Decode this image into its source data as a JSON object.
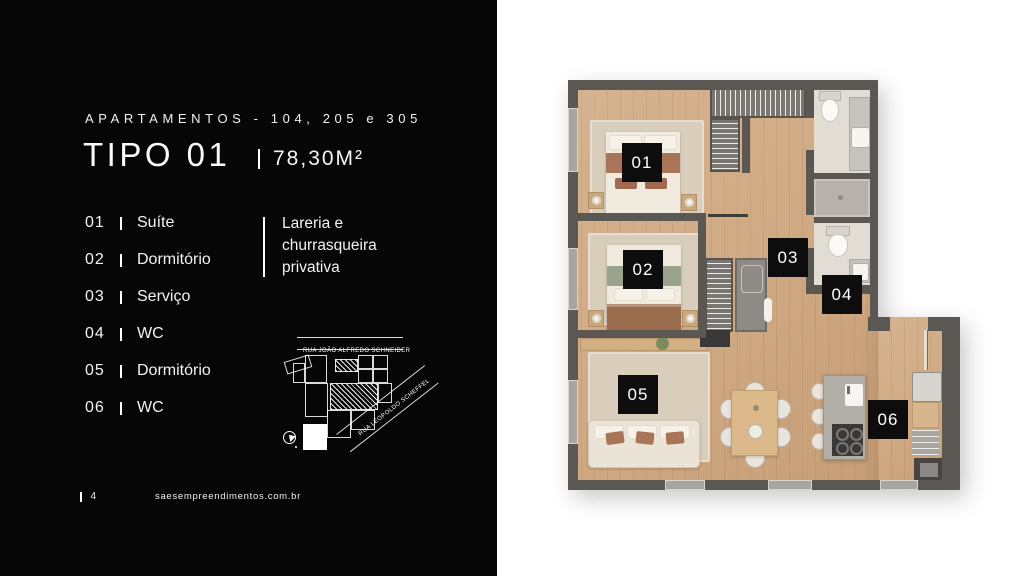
{
  "panel": {
    "subtitle": "APARTAMENTOS - 104, 205 e 305",
    "title": "TIPO 01",
    "area": "78,30M²",
    "rooms": [
      {
        "num": "01",
        "label": "Suíte"
      },
      {
        "num": "02",
        "label": "Dormitório"
      },
      {
        "num": "03",
        "label": "Serviço"
      },
      {
        "num": "04",
        "label": "WC"
      },
      {
        "num": "05",
        "label": "Dormitório"
      },
      {
        "num": "06",
        "label": "WC"
      }
    ],
    "feature": "Lareria e churrasqueira privativa",
    "map": {
      "street_top": "RUA JOÃO ALFREDO SCHNEIDER",
      "street_diagonal": "RUA LEOPOLDO SCHEFFEL"
    },
    "footer": {
      "page": "4",
      "site": "saesempreendimentos.com.br"
    }
  },
  "plan": {
    "badges": [
      "01",
      "02",
      "03",
      "04",
      "05",
      "06"
    ],
    "colors": {
      "wall": "#5b5753",
      "wood_floor": "#cfa982",
      "badge_bg": "#0d0d0d",
      "panel_bg": "#060606"
    }
  }
}
